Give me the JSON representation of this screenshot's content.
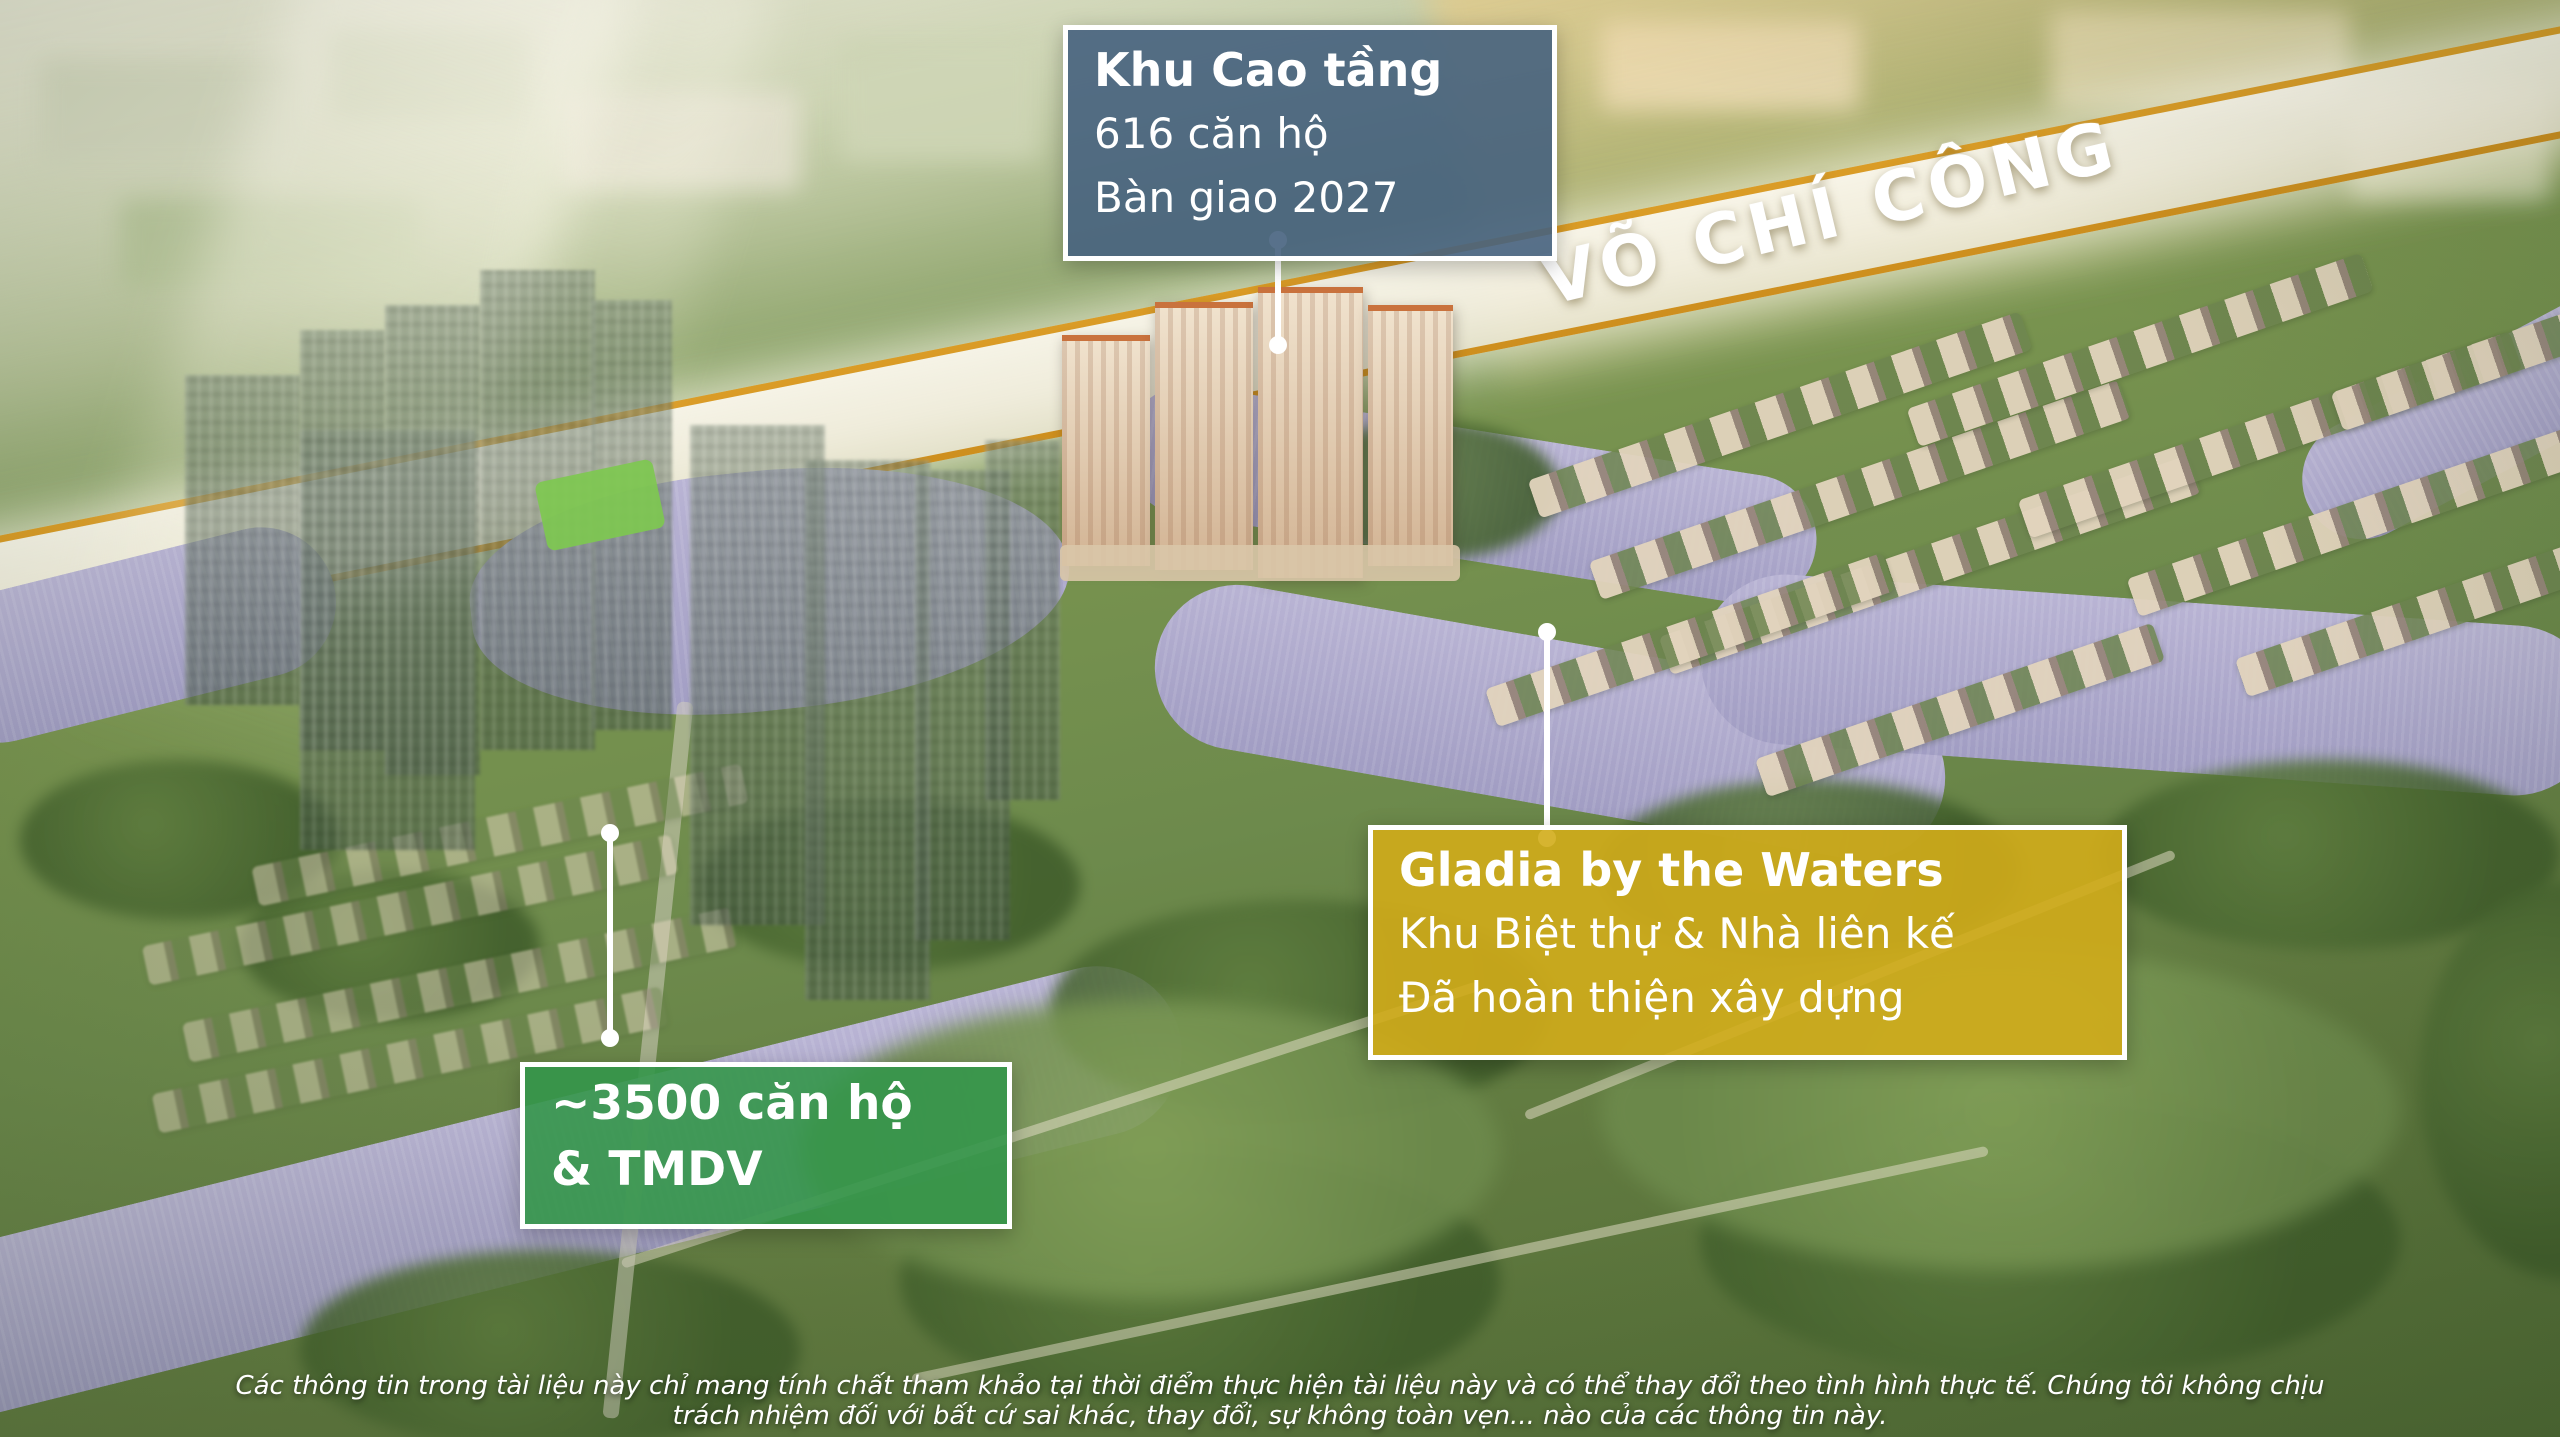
{
  "annotations": {
    "highrise": {
      "title": "Khu Cao tầng",
      "line1": "616 căn hộ",
      "line2": "Bàn giao 2027",
      "bg_color": "#46627E"
    },
    "gladia": {
      "title": "Gladia by the Waters",
      "line1": "Khu Biệt thự & Nhà liên kế",
      "line2": "Đã hoàn thiện xây dựng",
      "bg_color": "#D2AC19"
    },
    "future": {
      "line1": "~3500 căn hộ",
      "line2": "& TMDV",
      "bg_color": "#349649"
    }
  },
  "road": {
    "label": "VÕ CHÍ CÔNG",
    "band_color": "#F7F1E4",
    "edge_color": "#D89414"
  },
  "disclaimer": {
    "line1": "Các thông tin trong tài liệu này chỉ mang tính chất tham khảo tại thời điểm thực hiện tài liệu này và có thể thay đổi theo tình hình thực tế. Chúng tôi không chịu",
    "line2": "trách nhiệm đối với bất cứ sai khác, thay đổi, sự không toàn vẹn... nào của các thông tin này."
  },
  "scene_colors": {
    "water": "#ACA8CB",
    "greenery": "#6D8A4C",
    "callout_border": "#FFFFFF"
  }
}
